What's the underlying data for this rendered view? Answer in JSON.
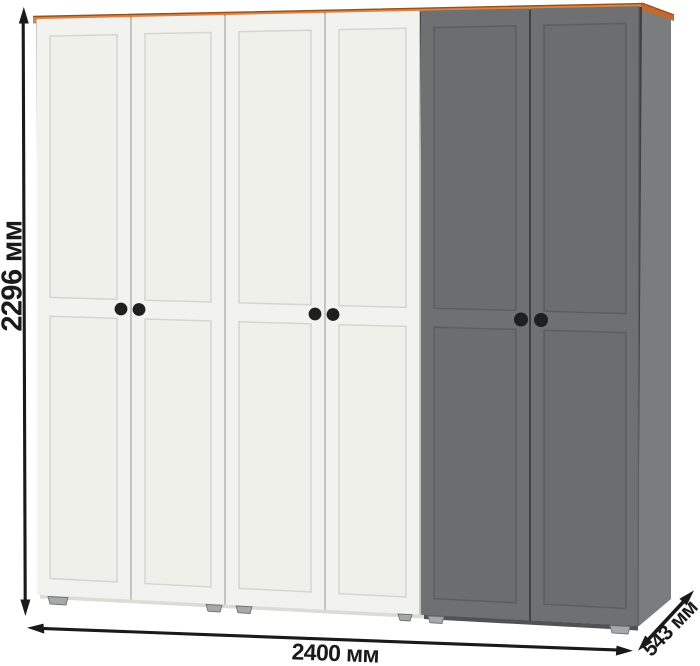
{
  "dimensions": {
    "height": {
      "label": "2296 мм",
      "value_mm": 2296
    },
    "width": {
      "label": "2400 мм",
      "value_mm": 2400
    },
    "depth": {
      "label": "543 мм",
      "value_mm": 543
    }
  },
  "wardrobe": {
    "doors_total": 6,
    "white_doors": 4,
    "gray_doors": 2,
    "knobs": 6,
    "feet_visible": 6
  },
  "colors": {
    "background": "#ffffff",
    "trim_orange": "#DD8243",
    "trim_orange_dark": "#C06A30",
    "trim_edge": "#93511F",
    "door_white": "#F2F2EF",
    "door_white_panel": "#F0F0EB",
    "door_white_line": "#D6D6D0",
    "door_gap_light": "#C4C4C0",
    "door_gray": "#6E7071",
    "door_gray_panel": "#6B6D6E",
    "door_gray_line": "#5B5D5F",
    "door_gap_dark": "#3E4042",
    "side_gray": "#7A7C7E",
    "base_light": "#DCDCD6",
    "base_dark": "#505254",
    "knob": "#1F1F1F",
    "foot": "#A6A8AA",
    "foot_dark": "#6F7173",
    "dimension": "#1A1A1A"
  }
}
